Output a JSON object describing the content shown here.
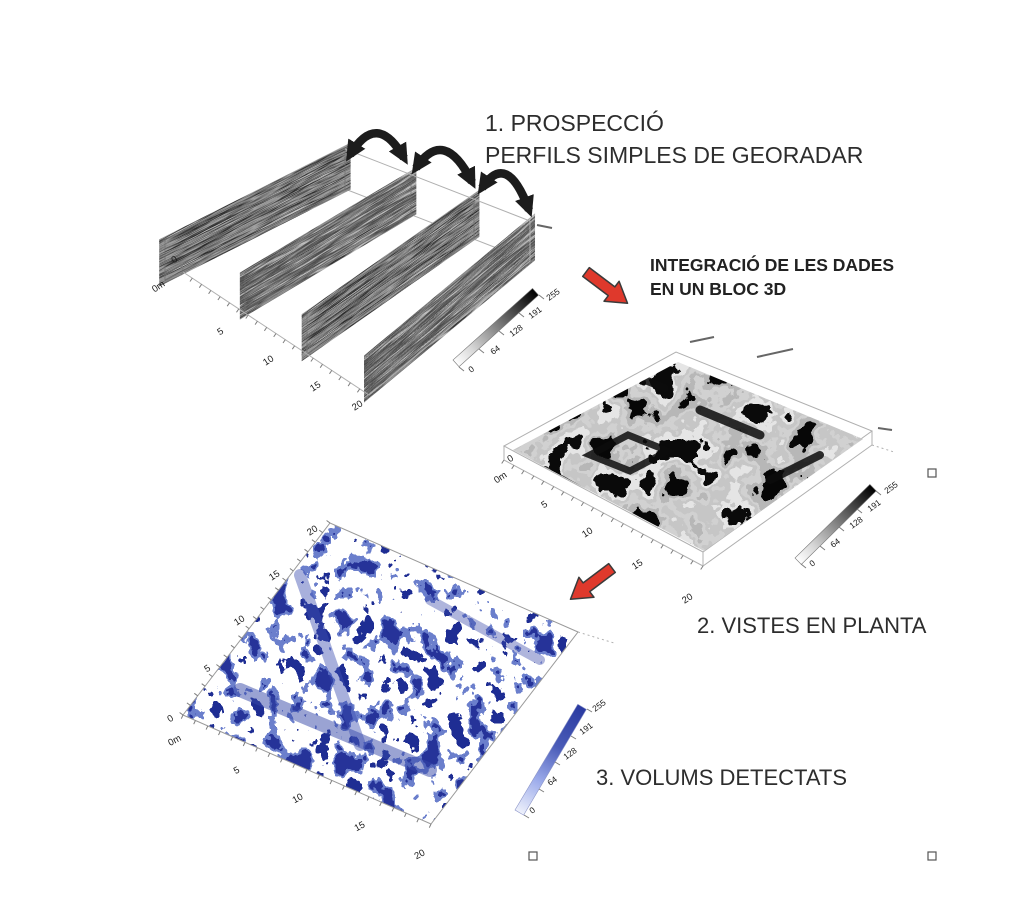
{
  "titles": {
    "step1_line1": "1. PROSPECCIÓ",
    "step1_line2": "PERFILS SIMPLES DE GEORADAR",
    "integration_line1": "INTEGRACIÓ DE LES DADES",
    "integration_line2": "EN UN BLOC 3D",
    "step2": "2. VISTES EN PLANTA",
    "step3": "3. VOLUMS DETECTATS"
  },
  "fence_plot": {
    "x_axis_ticks": [
      "0m",
      "5",
      "10",
      "15",
      "20"
    ],
    "depth_origin_label": "0",
    "colorbar_ticks": [
      "255",
      "191",
      "128",
      "64",
      "0"
    ]
  },
  "plan_plot": {
    "x_axis_ticks": [
      "0m",
      "5",
      "10",
      "15",
      "20"
    ],
    "depth_origin_label": "0",
    "colorbar_ticks": [
      "255",
      "191",
      "128",
      "64",
      "0"
    ]
  },
  "volume_plot": {
    "x_axis_ticks": [
      "0m",
      "5",
      "10",
      "15",
      "20"
    ],
    "y_axis_ticks": [
      "0",
      "5",
      "10",
      "15",
      "20"
    ],
    "colorbar_ticks": [
      "255",
      "191",
      "128",
      "64",
      "0"
    ]
  },
  "colors": {
    "red_arrow": "#df392c",
    "black_arrow": "#1c1c1c",
    "volume_blue_dark": "#2a3aa0",
    "volume_blue_light": "#9daceb",
    "title_text": "#2d2d2d"
  }
}
